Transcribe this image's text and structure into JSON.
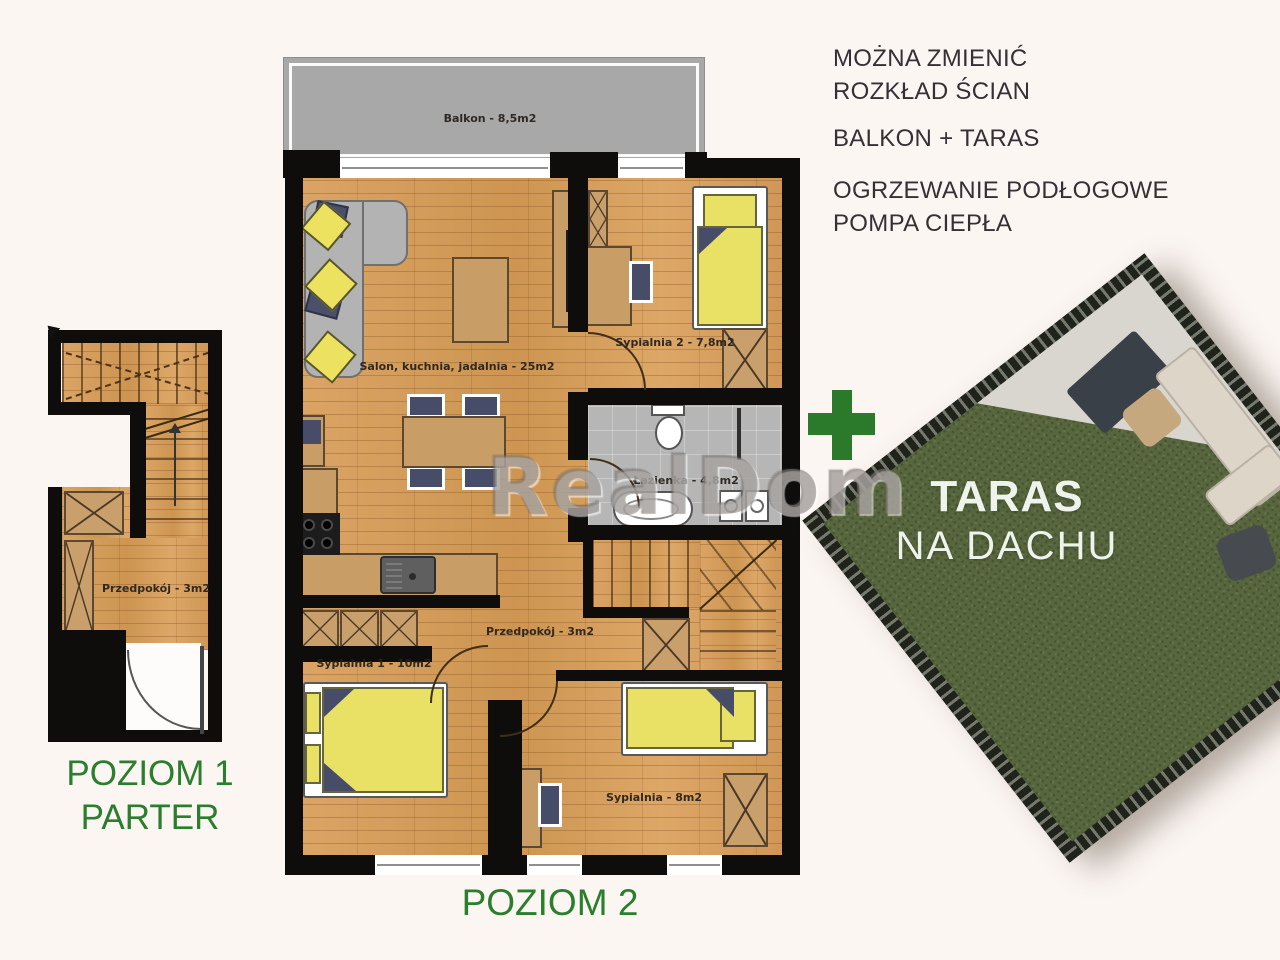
{
  "notes": {
    "block1_line1": "MOŻNA ZMIENIĆ",
    "block1_line2": "ROZKŁAD ŚCIAN",
    "block2": "BALKON + TARAS",
    "block3_line1": "OGRZEWANIE PODŁOGOWE",
    "block3_line2": "POMPA CIEPŁA"
  },
  "watermark": "RealDom",
  "level1": {
    "title_line1": "POZIOM 1",
    "title_line2": "PARTER",
    "rooms": {
      "przedpokoj": "Przedpokój - 3m2"
    }
  },
  "level2": {
    "title": "POZIOM 2",
    "rooms": {
      "balkon": "Balkon - 8,5m2",
      "salon": "Salon, kuchnia, jadalnia - 25m2",
      "sypialnia2": "Sypialnia 2 - 7,8m2",
      "lazienka": "Łazienka - 4,8m2",
      "przedpokoj": "Przedpokój - 3m2",
      "sypialnia1": "Sypialnia 1 - 10m2",
      "sypialnia": "Sypialnia - 8m2"
    }
  },
  "terrace": {
    "plus_icon": "+",
    "title": "TARAS",
    "subtitle": "NA DACHU"
  },
  "colors": {
    "accent_green": "#2b7e2e",
    "wall_black": "#0f0c0c",
    "floor_wood": "#d49a5a",
    "balcony_gray": "#a8a8a8",
    "bed_yellow": "#e9e166",
    "furniture_tan": "#c99d66",
    "navy": "#474d68",
    "terrace_green": "#57663d"
  }
}
